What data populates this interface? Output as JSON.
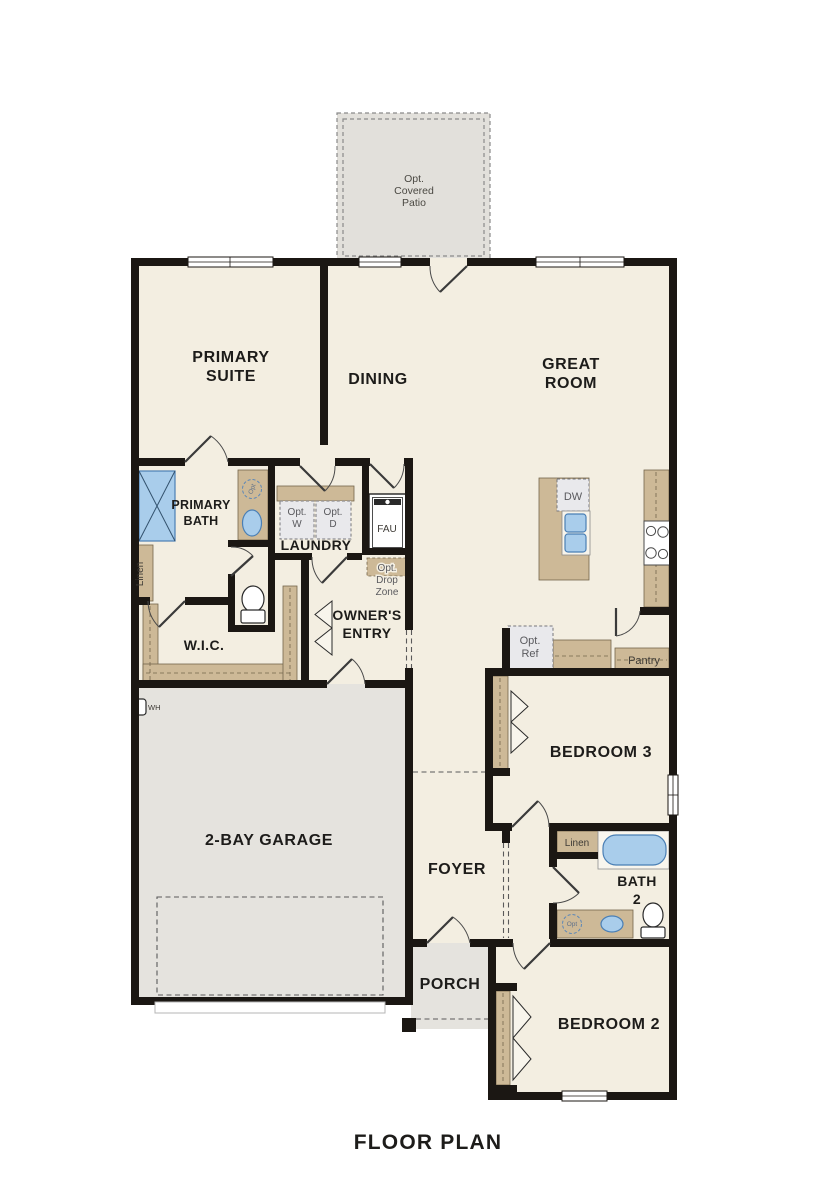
{
  "title": "FLOOR PLAN",
  "colors": {
    "floor": "#f3eee1",
    "garage_porch": "#e5e3de",
    "patio": "#e2e0db",
    "cabinet_tan": "#cdb997",
    "fixture_blue": "#a9cdeb",
    "wall_black": "#1b1713",
    "opt_box_fill": "#e9e9ec"
  },
  "rooms": {
    "patio": [
      "Opt.",
      "Covered",
      "Patio"
    ],
    "primary_suite": [
      "PRIMARY",
      "SUITE"
    ],
    "dining": "DINING",
    "great_room": [
      "GREAT",
      "ROOM"
    ],
    "primary_bath": [
      "PRIMARY",
      "BATH"
    ],
    "laundry": "LAUNDRY",
    "owners_entry": [
      "OWNER'S",
      "ENTRY"
    ],
    "wic": "W.I.C.",
    "garage": "2-BAY GARAGE",
    "bedroom3": "BEDROOM 3",
    "foyer": "FOYER",
    "bath2": [
      "BATH",
      "2"
    ],
    "bedroom2": "BEDROOM 2",
    "porch": "PORCH"
  },
  "fixtures": {
    "opt_w": [
      "Opt.",
      "W"
    ],
    "opt_d": [
      "Opt.",
      "D"
    ],
    "fau": "FAU",
    "opt_drop_zone": [
      "Opt.",
      "Drop",
      "Zone"
    ],
    "dw": "DW",
    "opt_ref": [
      "Opt.",
      "Ref"
    ],
    "pantry": "Pantry",
    "linen_primary": "Linen",
    "linen_bath2": "Linen",
    "wh": "WH",
    "opt_sink": "Opt"
  }
}
